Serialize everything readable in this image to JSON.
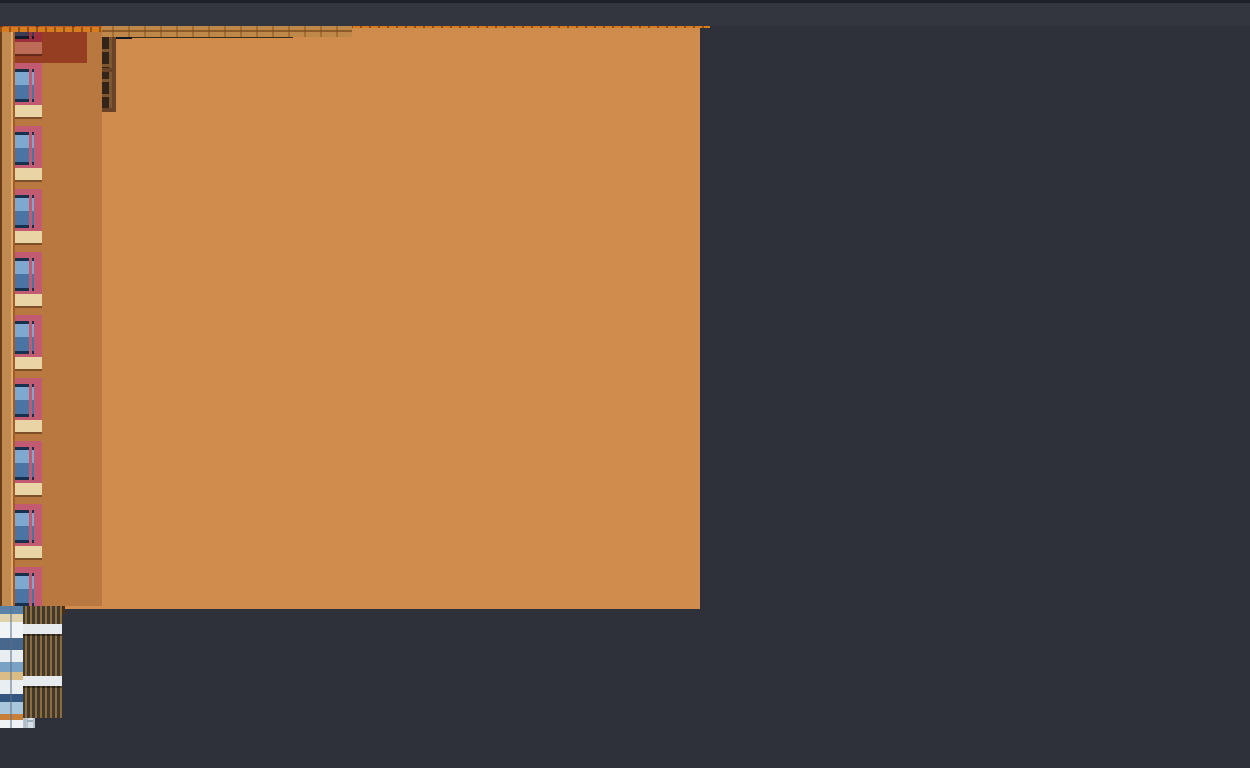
{
  "scene": {
    "type": "illustration",
    "style": "pixel-art cityscape, flat elevation view",
    "time_of_day": "dusk",
    "text_content": "none visible",
    "description": "Ornate orange-brick apartment block with bay windows and balconies on the left; narrow white grid tower, brick chimney and tan lattice service tower connected by red and white sky-bridges in the middle; white balcony high-rise, mosaic strip tower and pink-windowed brick tower on the right, under a dark slate sky."
  },
  "buildings": [
    {
      "name": "main-apartment-building",
      "material": "orange brick and stucco",
      "visible_floors": 5,
      "features": [
        "ornate multi-band brick cornice",
        "brown lattice bay windows",
        "balconies with blue glass and plants",
        "rows of narrow blue windows with white headers",
        "cream and gray floor bands",
        "storefront glass and brick base at street level",
        "narrow annex strip of stacked small rooms"
      ]
    },
    {
      "name": "white-grid-tower",
      "features": [
        "full-height gridded white shaft"
      ]
    },
    {
      "name": "brick-chimney",
      "features": [
        "short orange brick stack near top"
      ]
    },
    {
      "name": "lattice-service-tower",
      "features": [
        "tan gold lattice shaft",
        "beige caps at bridge levels"
      ]
    },
    {
      "name": "residential-highrise",
      "visible_floors": 14,
      "features": [
        "white grid pillars",
        "two columns of recessed balconies with rust slat railings",
        "white slab band each floor"
      ]
    },
    {
      "name": "mosaic-strip-tower",
      "features": [
        "narrow stack of small white, blue and tan panels"
      ]
    },
    {
      "name": "right-brick-building",
      "visible_floors": 10,
      "features": [
        "ornate orange brick cornice",
        "pink and red window surrounds",
        "navy windows with light blue panes",
        "beige sill band each floor",
        "dark brown corner column"
      ]
    }
  ],
  "sky_bridges": {
    "red_levels": 3,
    "light_gray_levels": 7,
    "dark_walkway_levels": 1
  },
  "street": {
    "visible": true,
    "position": "thin dark band at bottom edge"
  },
  "palette": {
    "sky": "#2e303a",
    "ground": "#34363f",
    "wall": "#d08c4c",
    "wallDeep": "#c98846",
    "rust": "#a85a28",
    "cream": "#ecdfba",
    "grayBand": "#8f8f8b",
    "corniceOrange": "#df8224",
    "corniceRed": "#b65c28",
    "corniceDark": "#46290f",
    "dentilLight": "#d49a58",
    "glassNavy": "#1c2a3c",
    "glassBlue": "#4a74a8",
    "glassLight": "#8fb4d8",
    "teal": "#3cc0c8",
    "latticeFrame": "#6a4226",
    "latticeGlass": "#33241a",
    "balconyNavy": "#24447c",
    "whiteTower": "#d7dfe6",
    "chimney": "#d4731f",
    "tanTower": "#c3a35c",
    "tanCap": "#ead9a8",
    "bridgeRed": "#b14a30",
    "bridgeWhite": "#ccd6dc",
    "hrRecess": "#514e46",
    "hrSlab": "#e7ebee",
    "hrPillar": "#e9edf0",
    "hrShade": "#a9b9c3",
    "mosaicBase": "#dfe7ee",
    "rbPink": "#c25a72",
    "rbBeige": "#e8d4a4",
    "rbSpandrel": "#b87840",
    "rbColumn": "#7e421c",
    "rbWindowBlue": "#4a74a4",
    "rbWindowLight": "#7fa8d0",
    "shopTeal": "#8fd8d4",
    "brick": "#c08848"
  }
}
